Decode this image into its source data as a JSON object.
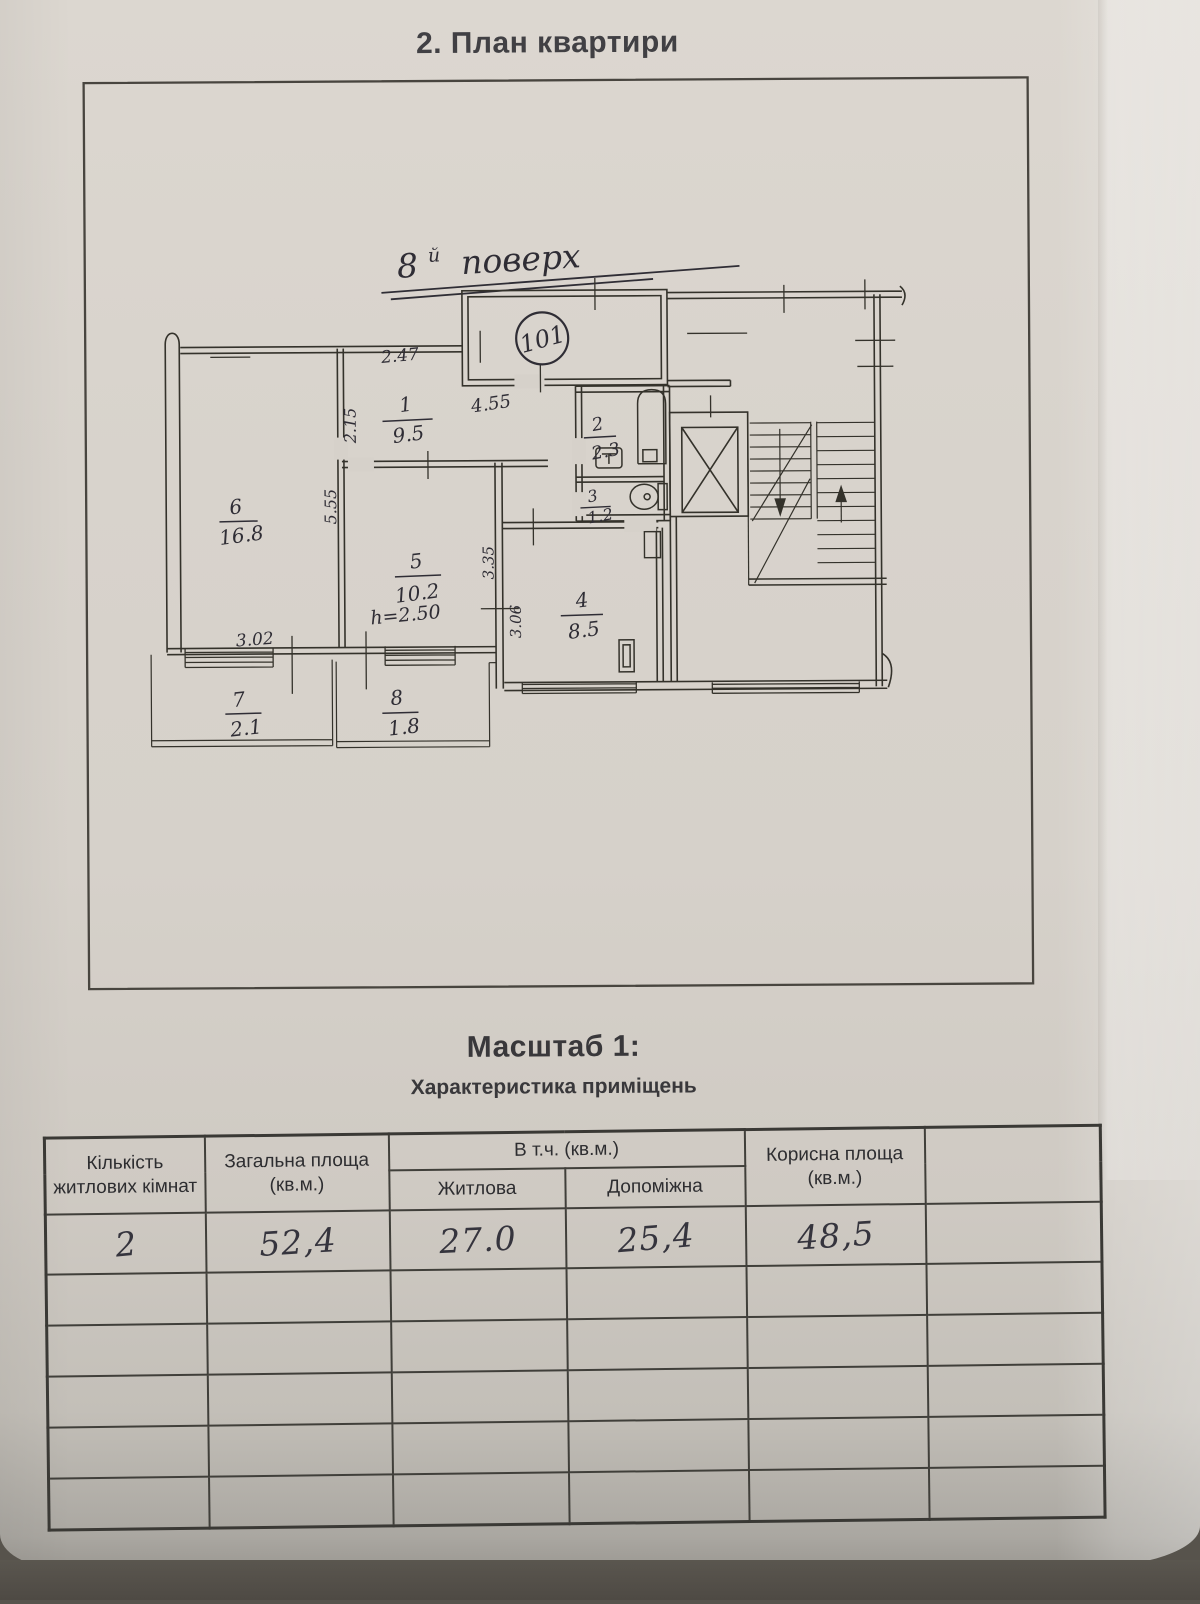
{
  "page": {
    "title": "2. План квартири"
  },
  "plan": {
    "floor_num": "8",
    "floor_suffix": "й",
    "floor_word": "поверх",
    "apartment_number": "101",
    "height_note": "h=2.50",
    "rooms": [
      {
        "num": "1",
        "area": "9.5"
      },
      {
        "num": "2",
        "area": "2.3"
      },
      {
        "num": "3",
        "area": "1.2"
      },
      {
        "num": "4",
        "area": "8.5"
      },
      {
        "num": "5",
        "area": "10.2"
      },
      {
        "num": "6",
        "area": "16.8"
      },
      {
        "num": "7",
        "area": "2.1"
      },
      {
        "num": "8",
        "area": "1.8"
      }
    ],
    "dims": {
      "corridor_width": "2.47",
      "hall_width": "4.55",
      "wall_left": "2.15",
      "room6_depth": "5.55",
      "room6_width": "3.02",
      "kitchen_depth_a": "3.35",
      "kitchen_depth_b": "3.06"
    }
  },
  "scale": {
    "heading": "Масштаб 1:"
  },
  "table": {
    "title": "Характеристика приміщень",
    "headers": {
      "col1_line1": "Кількість",
      "col1_line2": "житлових кімнат",
      "col2_line1": "Загальна площа",
      "col2_line2": "(кв.м.)",
      "group": "В т.ч. (кв.м.)",
      "sub1": "Житлова",
      "sub2": "Допоміжна",
      "col5_line1": "Корисна площа",
      "col5_line2": "(кв.м.)",
      "col6": ""
    },
    "row": {
      "rooms_count": "2",
      "total_area": "52,4",
      "living_area": "27.0",
      "auxiliary_area": "25,4",
      "useful_area": "48,5",
      "extra": ""
    }
  }
}
